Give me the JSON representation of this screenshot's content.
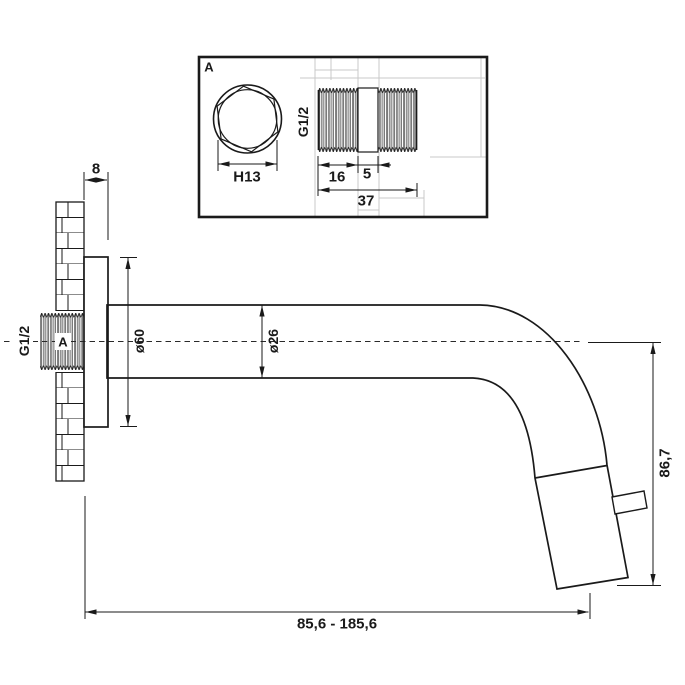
{
  "drawing": {
    "type": "technical-dimension-drawing",
    "subject": "wall-mounted-spout-side-view-with-thread-detail"
  },
  "detail_box": {
    "label": "A",
    "hex_dim": "H13",
    "thread_size": "G1/2",
    "len_thread": "16",
    "len_ring": "5",
    "len_total": "37"
  },
  "main_view": {
    "wall_plate_depth": "8",
    "thread_size": "G1/2",
    "thread_callout": "A",
    "flange_dia": "ø60",
    "spout_dia": "ø26",
    "outlet_height": "86,7",
    "reach_range": "85,6 - 185,6"
  },
  "colors": {
    "line": "#1a1a1a",
    "construction": "#c8c8c8",
    "background": "#ffffff"
  }
}
